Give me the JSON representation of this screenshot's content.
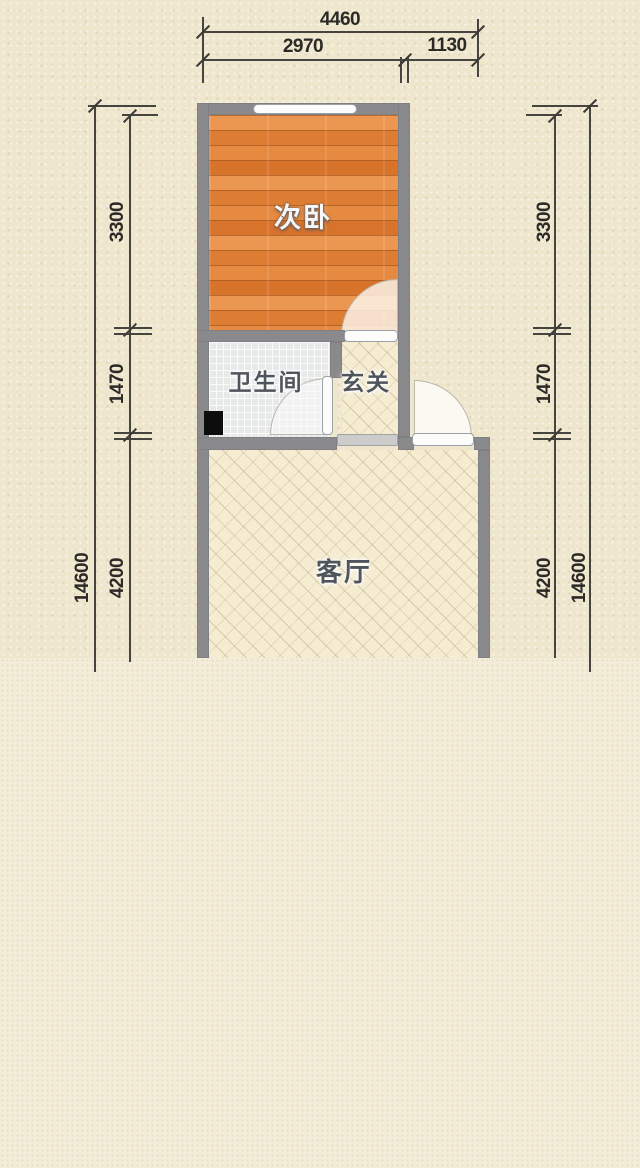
{
  "plan": {
    "rooms": {
      "bedroom": {
        "label": "次卧",
        "floor": "wood"
      },
      "bathroom": {
        "label": "卫生间",
        "floor": "tile"
      },
      "hall": {
        "label": "玄关",
        "floor": "hatch"
      },
      "living": {
        "label": "客厅",
        "floor": "hatch"
      }
    },
    "features": [
      "window",
      "bedroom-door",
      "bathroom-door",
      "entrance-door",
      "threshold-opening",
      "black-fixture"
    ]
  },
  "dimensions": {
    "top": {
      "overall": "4460",
      "seg1": "2970",
      "seg2": "1130"
    },
    "left": {
      "overall": "14600",
      "seg1": "3300",
      "seg2": "1470",
      "seg3": "4200"
    },
    "right": {
      "overall": "14600",
      "seg1": "3300",
      "seg2": "1470",
      "seg3": "4200"
    }
  },
  "colors": {
    "wall": "#8a8a8d",
    "wood_floor": "#e0823a",
    "tile_floor": "#e6e9e8",
    "hatch_floor": "#f5ecd2",
    "dimension_line": "#45443f",
    "dimension_text": "#2b2a26",
    "background_upper": "#efe6ce",
    "background_lower": "#f3ecd9"
  }
}
